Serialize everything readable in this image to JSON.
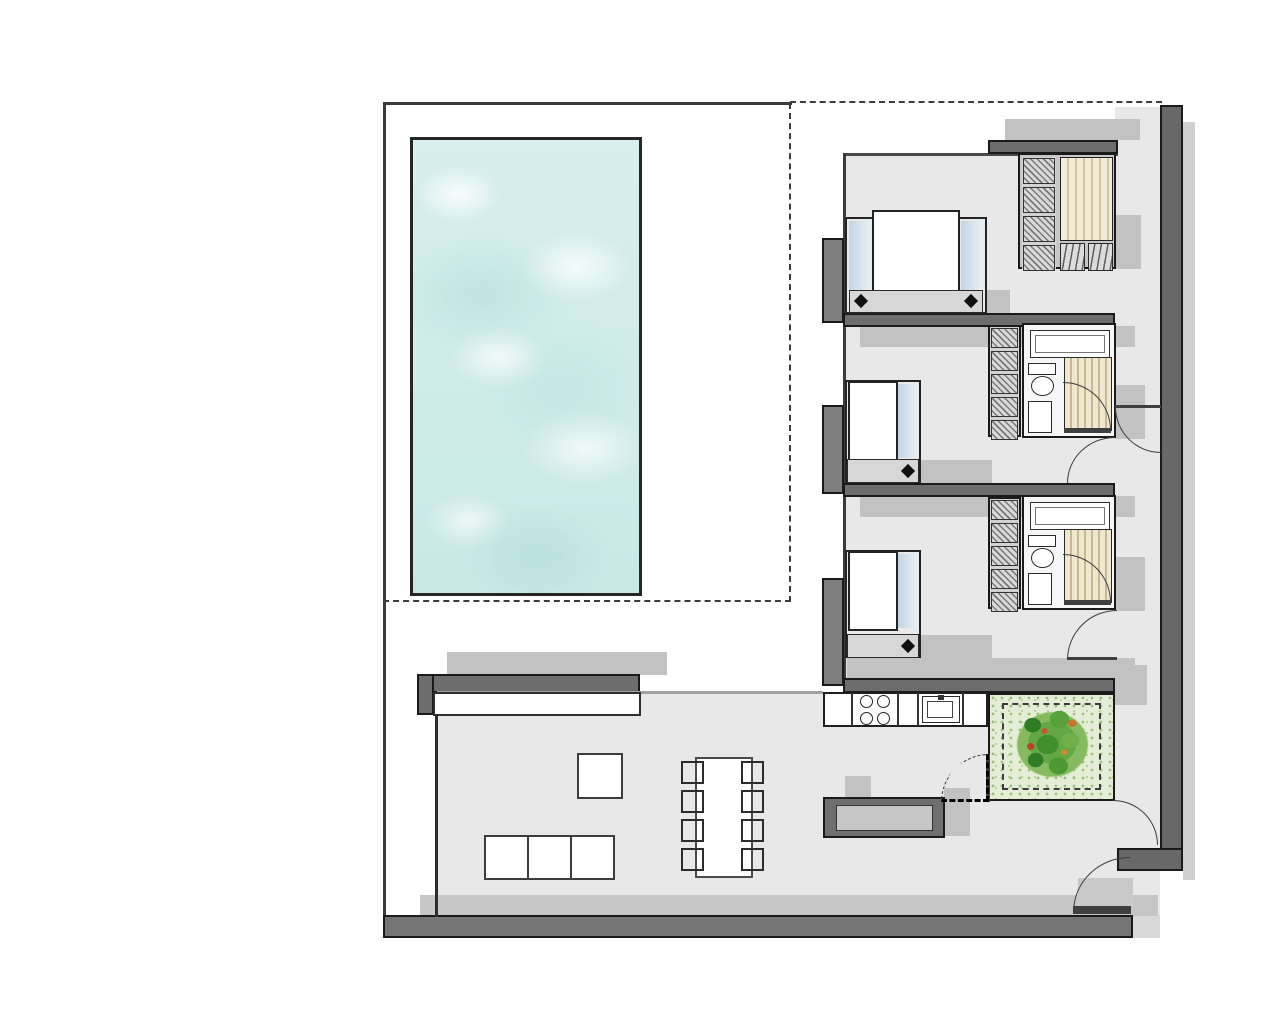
{
  "document": {
    "type": "architectural floor plan, axonometric-shadow style, no text labels",
    "canvas": {
      "width": 1280,
      "height": 1024,
      "background": "#ffffff"
    }
  },
  "palette": {
    "wall_dark": "#6d6d6d",
    "wall_pier": "#7e7e7e",
    "outline": "#1a1a1a",
    "floor_gray": "#e8e8e8",
    "cast_shadow": "#c2c2c2",
    "pool_water": "#cfe9e8",
    "pool_highlight": "#ffffff",
    "closet_tan": "#f1e9d2",
    "closet_tan_stripe": "#d2c59e",
    "bed_pillow_blue": "#d3e2ec",
    "bed_footer_gray": "#d7d7d7",
    "courtyard_green": "#e4eed6",
    "tree_green_dark": "#2f7d27",
    "tree_green_mid": "#57a23b",
    "tree_green_light": "#85bb5e",
    "tree_accent_orange": "#cc6f2f",
    "tree_accent_red": "#b8452b",
    "bench_seat_gray": "#c6c6c6"
  },
  "elements": {
    "pool": {
      "count": 1
    },
    "terrace": {
      "boundary_style": "solid top/left, dashed right/bottom and roof line"
    },
    "beds": {
      "double": 1,
      "single": 2,
      "bedside_lamp_dots": 4
    },
    "wardrobe": {
      "shelf_cells_master": 4,
      "shelf_cells_bedroom": 5,
      "drawers": 2,
      "hanging_sections": 1
    },
    "bathrooms": {
      "count": 2,
      "fixtures_each": [
        "sink-counter",
        "toilet",
        "shower"
      ]
    },
    "kitchen": {
      "burners": 4,
      "sinks": 1
    },
    "dining": {
      "chairs_per_side": 4,
      "sides": 2,
      "tables": 1
    },
    "sofa": {
      "seats": 3
    },
    "side_table": {
      "count": 1
    },
    "bench": {
      "count": 1
    },
    "courtyard": {
      "trees": 1,
      "dashed_planter_squares": 1
    },
    "doors": {
      "swing_arcs": 7,
      "dashed_swing_arcs": 1
    }
  }
}
